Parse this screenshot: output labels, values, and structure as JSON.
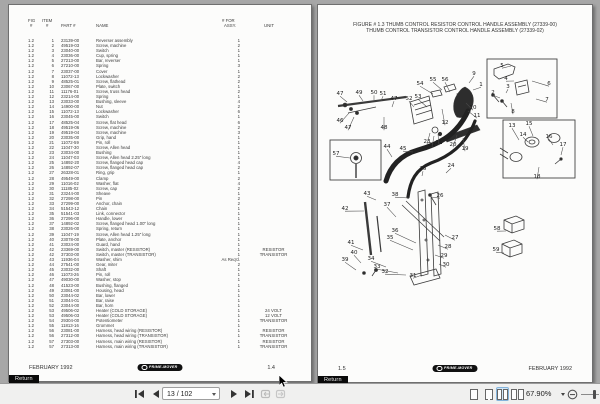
{
  "toolbar": {
    "page_indicator": "13 / 102",
    "zoom_level": "67.90%"
  },
  "left_page": {
    "header": {
      "fig_top": "FIG",
      "item_top": "ITEM",
      "fig_bottom": "#",
      "item_bottom": "#",
      "part": "PART #",
      "name": "NAME",
      "qty_top": "# FOR",
      "qty_bottom": "ASSY.",
      "unit": "UNIT"
    },
    "rows": [
      [
        "1.2",
        "1",
        "23139-00",
        "Reverser assembly",
        "1",
        ""
      ],
      [
        "1.2",
        "2",
        "49519-03",
        "Screw, machine",
        "2",
        ""
      ],
      [
        "1.2",
        "3",
        "23040-00",
        "Switch",
        "1",
        ""
      ],
      [
        "1.2",
        "4",
        "23036-00",
        "Cup, spring",
        "1",
        ""
      ],
      [
        "1.2",
        "5",
        "27213-00",
        "Bar, reverser",
        "1",
        ""
      ],
      [
        "1.2",
        "6",
        "27210-00",
        "Spring",
        "3",
        ""
      ],
      [
        "1.2",
        "7",
        "23037-00",
        "Cover",
        "1",
        ""
      ],
      [
        "1.2",
        "8",
        "11072-13",
        "Lockwasher",
        "2",
        ""
      ],
      [
        "1.2",
        "9",
        "48525-01",
        "Screw, flathead",
        "2",
        ""
      ],
      [
        "1.2",
        "10",
        "23067-00",
        "Plate, switch",
        "1",
        ""
      ],
      [
        "1.2",
        "11",
        "11176-01",
        "Screw, truss head",
        "2",
        ""
      ],
      [
        "1.2",
        "12",
        "23214-00",
        "Spring",
        "1",
        ""
      ],
      [
        "1.2",
        "13",
        "23033-00",
        "Bushing, sleeve",
        "4",
        ""
      ],
      [
        "1.2",
        "14",
        "14900-00",
        "Nut",
        "2",
        ""
      ],
      [
        "1.2",
        "15",
        "11072-13",
        "Lockwasher",
        "6",
        ""
      ],
      [
        "1.2",
        "16",
        "23045-00",
        "Switch",
        "1",
        ""
      ],
      [
        "1.2",
        "17",
        "48525-04",
        "Screw, flat head",
        "6",
        ""
      ],
      [
        "1.2",
        "18",
        "49519-06",
        "Screw, machine",
        "2",
        ""
      ],
      [
        "1.2",
        "19",
        "49519-04",
        "Screw, machine",
        "3",
        ""
      ],
      [
        "1.2",
        "20",
        "23035-00",
        "Grip, hand",
        "1",
        ""
      ],
      [
        "1.2",
        "21",
        "11072-59",
        "Pin, roll",
        "1",
        ""
      ],
      [
        "1.2",
        "22",
        "11047-30",
        "Screw, Allen head",
        "1",
        ""
      ],
      [
        "1.2",
        "23",
        "23034-00",
        "Bushing",
        "1",
        ""
      ],
      [
        "1.2",
        "24",
        "11047-03",
        "Screw, Allen head 2.25\" long",
        "1",
        ""
      ],
      [
        "1.2",
        "25",
        "14892-20",
        "Screw, flanged head cap",
        "4",
        ""
      ],
      [
        "1.2",
        "26",
        "14892-07",
        "Screw, flanged head cap",
        "2",
        ""
      ],
      [
        "1.2",
        "27",
        "26328-01",
        "Ring, grip",
        "1",
        ""
      ],
      [
        "1.2",
        "28",
        "49549-00",
        "Clamp",
        "2",
        ""
      ],
      [
        "1.2",
        "29",
        "11016-02",
        "Washer, flat",
        "4",
        ""
      ],
      [
        "1.2",
        "30",
        "11185-02",
        "Screw, cap",
        "2",
        ""
      ],
      [
        "1.2",
        "31",
        "23244-00",
        "Sheave",
        "1",
        ""
      ],
      [
        "1.2",
        "32",
        "27298-00",
        "Pin",
        "2",
        ""
      ],
      [
        "1.2",
        "33",
        "27299-00",
        "Anchor, chain",
        "2",
        ""
      ],
      [
        "1.2",
        "34",
        "51543-12",
        "Chain",
        "1",
        ""
      ],
      [
        "1.2",
        "35",
        "51541-03",
        "Link, connector",
        "1",
        ""
      ],
      [
        "1.2",
        "36",
        "27296-00",
        "Handle, lower",
        "1",
        ""
      ],
      [
        "1.2",
        "37",
        "14892-02",
        "Screw, flanged head 1.00\" long",
        "1",
        ""
      ],
      [
        "1.2",
        "38",
        "23026-00",
        "Spring, return",
        "1",
        ""
      ],
      [
        "1.2",
        "39",
        "11047-19",
        "Screw, Allen head 1.25\" long",
        "1",
        ""
      ],
      [
        "1.2",
        "40",
        "23078-00",
        "Plate, anchor",
        "1",
        ""
      ],
      [
        "1.2",
        "41",
        "23024-00",
        "Guard, hand",
        "1",
        ""
      ],
      [
        "1.2",
        "42",
        "23369-00",
        "Switch, master (RESISTOR)",
        "1",
        "RESISTOR"
      ],
      [
        "1.2",
        "42",
        "37303-00",
        "Switch, master (TRANSISTOR)",
        "1",
        "TRANSISTOR"
      ],
      [
        "1.2",
        "43",
        "11936-04",
        "Washer, shim",
        "As Req'd.",
        ""
      ],
      [
        "1.2",
        "44",
        "27541-00",
        "Gear, miter",
        "2",
        ""
      ],
      [
        "1.2",
        "45",
        "23032-00",
        "Shaft",
        "1",
        ""
      ],
      [
        "1.2",
        "46",
        "11073-26",
        "Pin, roll",
        "1",
        ""
      ],
      [
        "1.2",
        "47",
        "49030-00",
        "Washer, stop",
        "1",
        ""
      ],
      [
        "1.2",
        "48",
        "41523-00",
        "Bushing, flanged",
        "1",
        ""
      ],
      [
        "1.2",
        "49",
        "23061-00",
        "Housing, head",
        "1",
        ""
      ],
      [
        "1.2",
        "50",
        "23044-02",
        "Bar, lower",
        "1",
        ""
      ],
      [
        "1.2",
        "51",
        "23044-01",
        "Bar, raise",
        "1",
        ""
      ],
      [
        "1.2",
        "52",
        "23044-00",
        "Bar, horn",
        "1",
        ""
      ],
      [
        "1.2",
        "53",
        "49506-02",
        "Heater (COLD STORAGE)",
        "1",
        "24 VOLT"
      ],
      [
        "1.2",
        "53",
        "49506-03",
        "Heater (COLD STORAGE)",
        "1",
        "12 VOLT"
      ],
      [
        "1.2",
        "54",
        "29304-00",
        "Potentiometer",
        "1",
        "TRANSISTOR"
      ],
      [
        "1.2",
        "55",
        "11813-16",
        "Grommet",
        "1",
        ""
      ],
      [
        "1.2",
        "56",
        "23081-00",
        "Harness, head wiring (RESISTOR)",
        "1",
        "RESISTOR"
      ],
      [
        "1.2",
        "56",
        "27312-00",
        "Harness, head wiring (TRANSISTOR)",
        "1",
        "TRANSISTOR"
      ],
      [
        "1.2",
        "57",
        "27303-00",
        "Harness, main wiring (RESISTOR)",
        "1",
        "RESISTOR"
      ],
      [
        "1.2",
        "57",
        "27313-00",
        "Harness, main wiring (TRANSISTOR)",
        "1",
        "TRANSISTOR"
      ]
    ],
    "footer_left": "FEBRUARY 1992",
    "footer_page": "1.4",
    "logo": "PRIME-MOVER",
    "return_label": "Return"
  },
  "right_page": {
    "title_line1": "FIGURE # 1.3 THUMB CONTROL RESISTOR CONTROL HANDLE ASSEMBLY (27339-00)",
    "title_line2": "THUMB CONTROL TRANSISTOR CONTROL HANDLE ASSEMBLY (27339-02)",
    "callouts": [
      [
        "1",
        163,
        39,
        155,
        45
      ],
      [
        "2",
        175,
        47,
        182,
        53
      ],
      [
        "3",
        190,
        41,
        188,
        48
      ],
      [
        "4",
        188,
        33,
        196,
        36
      ],
      [
        "5",
        184,
        20,
        193,
        21
      ],
      [
        "6",
        231,
        38,
        214,
        36
      ],
      [
        "7",
        229,
        54,
        218,
        54
      ],
      [
        "8",
        195,
        66,
        193,
        58
      ],
      [
        "9",
        156,
        28,
        151,
        38
      ],
      [
        "10",
        155,
        62,
        148,
        58
      ],
      [
        "11",
        159,
        70,
        150,
        66
      ],
      [
        "12",
        127,
        77,
        124,
        64
      ],
      [
        "13",
        194,
        80,
        201,
        95
      ],
      [
        "14",
        205,
        89,
        210,
        97
      ],
      [
        "15",
        211,
        78,
        215,
        91
      ],
      [
        "16",
        231,
        91,
        235,
        100
      ],
      [
        "17",
        245,
        99,
        243,
        110
      ],
      [
        "18",
        219,
        131,
        221,
        122
      ],
      [
        "19",
        147,
        103,
        145,
        93
      ],
      [
        "20",
        135,
        99,
        139,
        90
      ],
      [
        "21",
        121,
        97,
        120,
        89
      ],
      [
        "22",
        114,
        99,
        116,
        91
      ],
      [
        "23",
        109,
        96,
        112,
        88
      ],
      [
        "24",
        133,
        120,
        128,
        128
      ],
      [
        "25",
        105,
        123,
        104,
        131
      ],
      [
        "26",
        122,
        150,
        113,
        152
      ],
      [
        "27",
        137,
        192,
        127,
        190
      ],
      [
        "28",
        130,
        201,
        120,
        200
      ],
      [
        "29",
        126,
        210,
        117,
        210
      ],
      [
        "30",
        128,
        219,
        121,
        219
      ],
      [
        "31",
        95,
        230,
        104,
        230
      ],
      [
        "32",
        67,
        226,
        88,
        230
      ],
      [
        "33",
        59,
        221,
        80,
        228
      ],
      [
        "34",
        53,
        213,
        68,
        222
      ],
      [
        "35",
        72,
        192,
        95,
        205
      ],
      [
        "36",
        77,
        185,
        98,
        198
      ],
      [
        "37",
        69,
        159,
        78,
        172
      ],
      [
        "38",
        77,
        149,
        91,
        153
      ],
      [
        "39",
        27,
        214,
        38,
        225
      ],
      [
        "40",
        36,
        207,
        43,
        218
      ],
      [
        "41",
        33,
        197,
        45,
        205
      ],
      [
        "42",
        27,
        163,
        46,
        166
      ],
      [
        "43",
        49,
        148,
        58,
        155
      ],
      [
        "44",
        69,
        101,
        74,
        112
      ],
      [
        "45",
        85,
        103,
        95,
        107
      ],
      [
        "46",
        22,
        75,
        31,
        68
      ],
      [
        "47",
        22,
        48,
        29,
        57
      ],
      [
        "47",
        76,
        53,
        74,
        62
      ],
      [
        "47",
        30,
        82,
        36,
        72
      ],
      [
        "48",
        66,
        82,
        66,
        72
      ],
      [
        "49",
        41,
        47,
        45,
        56
      ],
      [
        "50",
        56,
        47,
        56,
        55
      ],
      [
        "51",
        65,
        48,
        63,
        56
      ],
      [
        "52",
        91,
        53,
        96,
        62
      ],
      [
        "53",
        100,
        51,
        109,
        62
      ],
      [
        "54",
        102,
        38,
        115,
        49
      ],
      [
        "55",
        115,
        34,
        124,
        45
      ],
      [
        "56",
        127,
        34,
        132,
        47
      ],
      [
        "57",
        18,
        108,
        32,
        113
      ],
      [
        "58",
        179,
        183,
        188,
        186
      ],
      [
        "59",
        178,
        204,
        186,
        208
      ]
    ],
    "footer_page": "1.5",
    "footer_right": "FEBRUARY 1992",
    "logo": "PRIME-MOVER",
    "return_label": "Return"
  }
}
